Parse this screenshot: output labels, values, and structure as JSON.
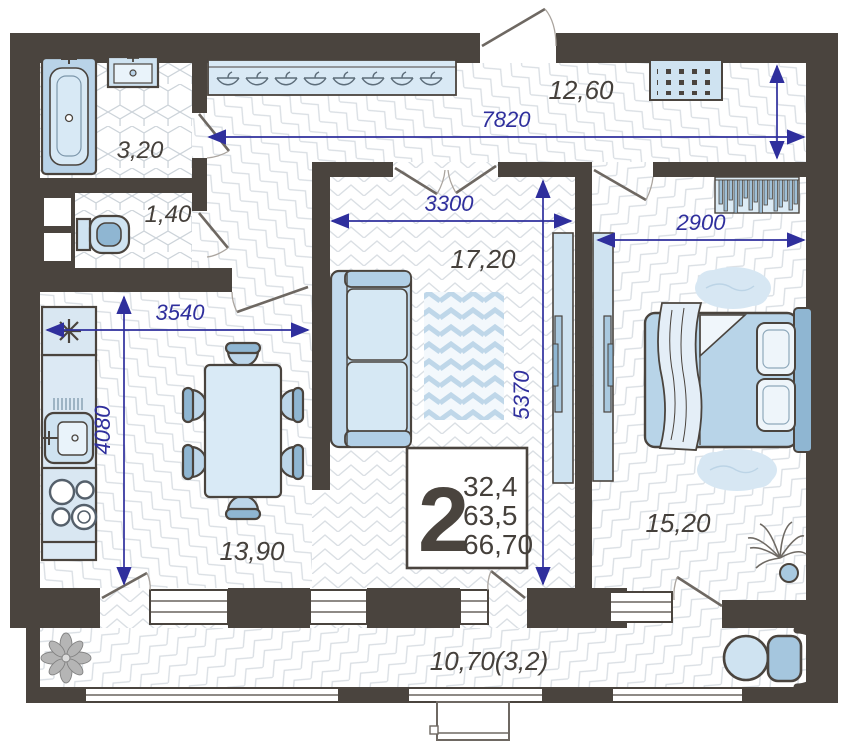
{
  "plan": {
    "type": "apartment-floor-plan",
    "info_box": {
      "rooms_count": "2",
      "area_living": "32,4",
      "area_usable": "63,5",
      "area_total": "66,70"
    },
    "rooms": {
      "bathroom": {
        "label": "3,20"
      },
      "toilet": {
        "label": "1,40"
      },
      "hallway": {
        "label": "12,60"
      },
      "living": {
        "label": "17,20"
      },
      "kitchen": {
        "label": "13,90"
      },
      "bedroom": {
        "label": "15,20"
      },
      "balcony": {
        "label": "10,70(3,2)"
      }
    },
    "dims": {
      "hall_width": "7820",
      "living_width": "3300",
      "bedroom_width": "2900",
      "kitchen_width": "3540",
      "kitchen_height": "4080",
      "living_height": "5370"
    },
    "icons": [
      "bathtub-icon",
      "washbasin-icon",
      "toilet-icon",
      "coat-rack-icon",
      "doormat-icon",
      "wardrobe-icon",
      "fridge-icon",
      "sink-icon",
      "stove-icon",
      "dining-table-icon",
      "chair-icon",
      "sofa-icon",
      "rug-icon",
      "tv-panel-icon",
      "bed-icon",
      "pillow-icon",
      "plant-icon",
      "palm-icon",
      "balcony-table-icon",
      "balcony-chair-icon"
    ],
    "colors": {
      "wall": "#4a443e",
      "dimension": "#2f2f9d",
      "furniture_light": "#d8e9f5",
      "furniture_mid": "#bcd6ea",
      "furniture_dark": "#8fb6d2"
    }
  }
}
